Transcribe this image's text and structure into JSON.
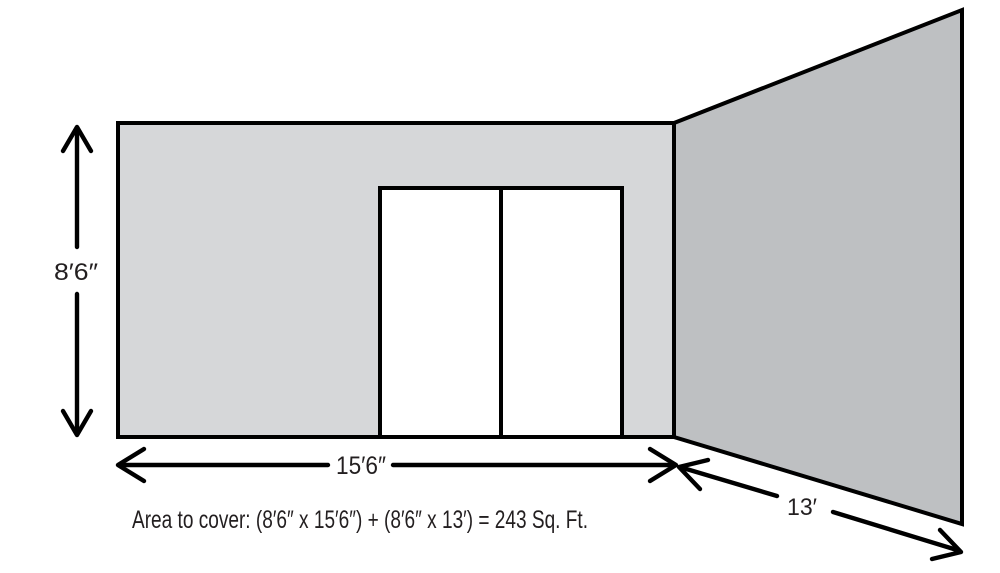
{
  "labels": {
    "height": "8′6″",
    "width": "15′6″",
    "depth": "13′"
  },
  "formula": "Area to cover: (8′6″ x 15′6″) + (8′6″ x 13′) = 243 Sq. Ft.",
  "colors": {
    "front_wall": "#d6d7d9",
    "side_wall": "#bec0c2",
    "door": "#ffffff",
    "outline": "#000000",
    "text": "#231f20",
    "background": "#ffffff"
  }
}
